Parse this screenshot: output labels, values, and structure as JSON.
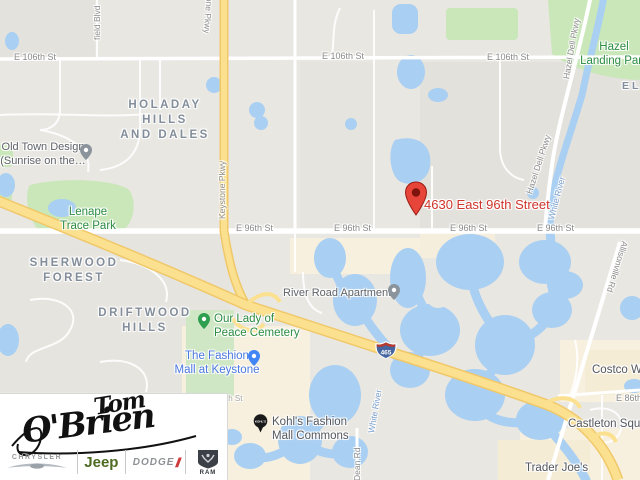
{
  "map": {
    "address": "4630 East 96th Street",
    "streets": {
      "e106": "E 106th St",
      "e96": "E 96th St",
      "e86": "E 86th St",
      "partial_th": "th St",
      "keystone": "Keystone Pkwy",
      "westfield": "field Blvd",
      "hazel_dell": "Hazel Dell Pkwy",
      "allisonville": "Allisonville Rd",
      "dean": "Dean Rd",
      "i465": "465"
    },
    "water": {
      "white_river": "White River"
    },
    "neighborhoods": {
      "holaday": "HOLADAY HILLS\nAND DALES",
      "sherwood": "SHERWOOD\nFOREST",
      "driftwood": "DRIFTWOOD\nHILLS",
      "el": "EL"
    },
    "places": {
      "old_town": "Old Town Design\n(Sunrise on the…",
      "lenape": "Lenape\nTrace Park",
      "hazel_landing": "Hazel\nLanding Park",
      "cemetery": "Our Lady of\nPeace Cemetery",
      "fashion_mall": "The Fashion\nMall at Keystone",
      "river_road": "River Road Apartments",
      "kohls": "Kohl's Fashion\nMall Commons",
      "kohls_badge": "KOHL'S",
      "trader_joes": "Trader Joe's",
      "costco": "Costco Wholesale",
      "castleton": "Castleton Square"
    }
  },
  "logo": {
    "name_top": "Tom",
    "name_bottom": "O'Brien",
    "brands": {
      "chrysler": "CHRYSLER",
      "jeep": "Jeep",
      "dodge": "DODGE",
      "ram": "RAM"
    }
  },
  "colors": {
    "accent_red": "#cf352b",
    "water": "#a9cff2",
    "park": "#c9e7b9",
    "highway": "#fbe18f"
  }
}
